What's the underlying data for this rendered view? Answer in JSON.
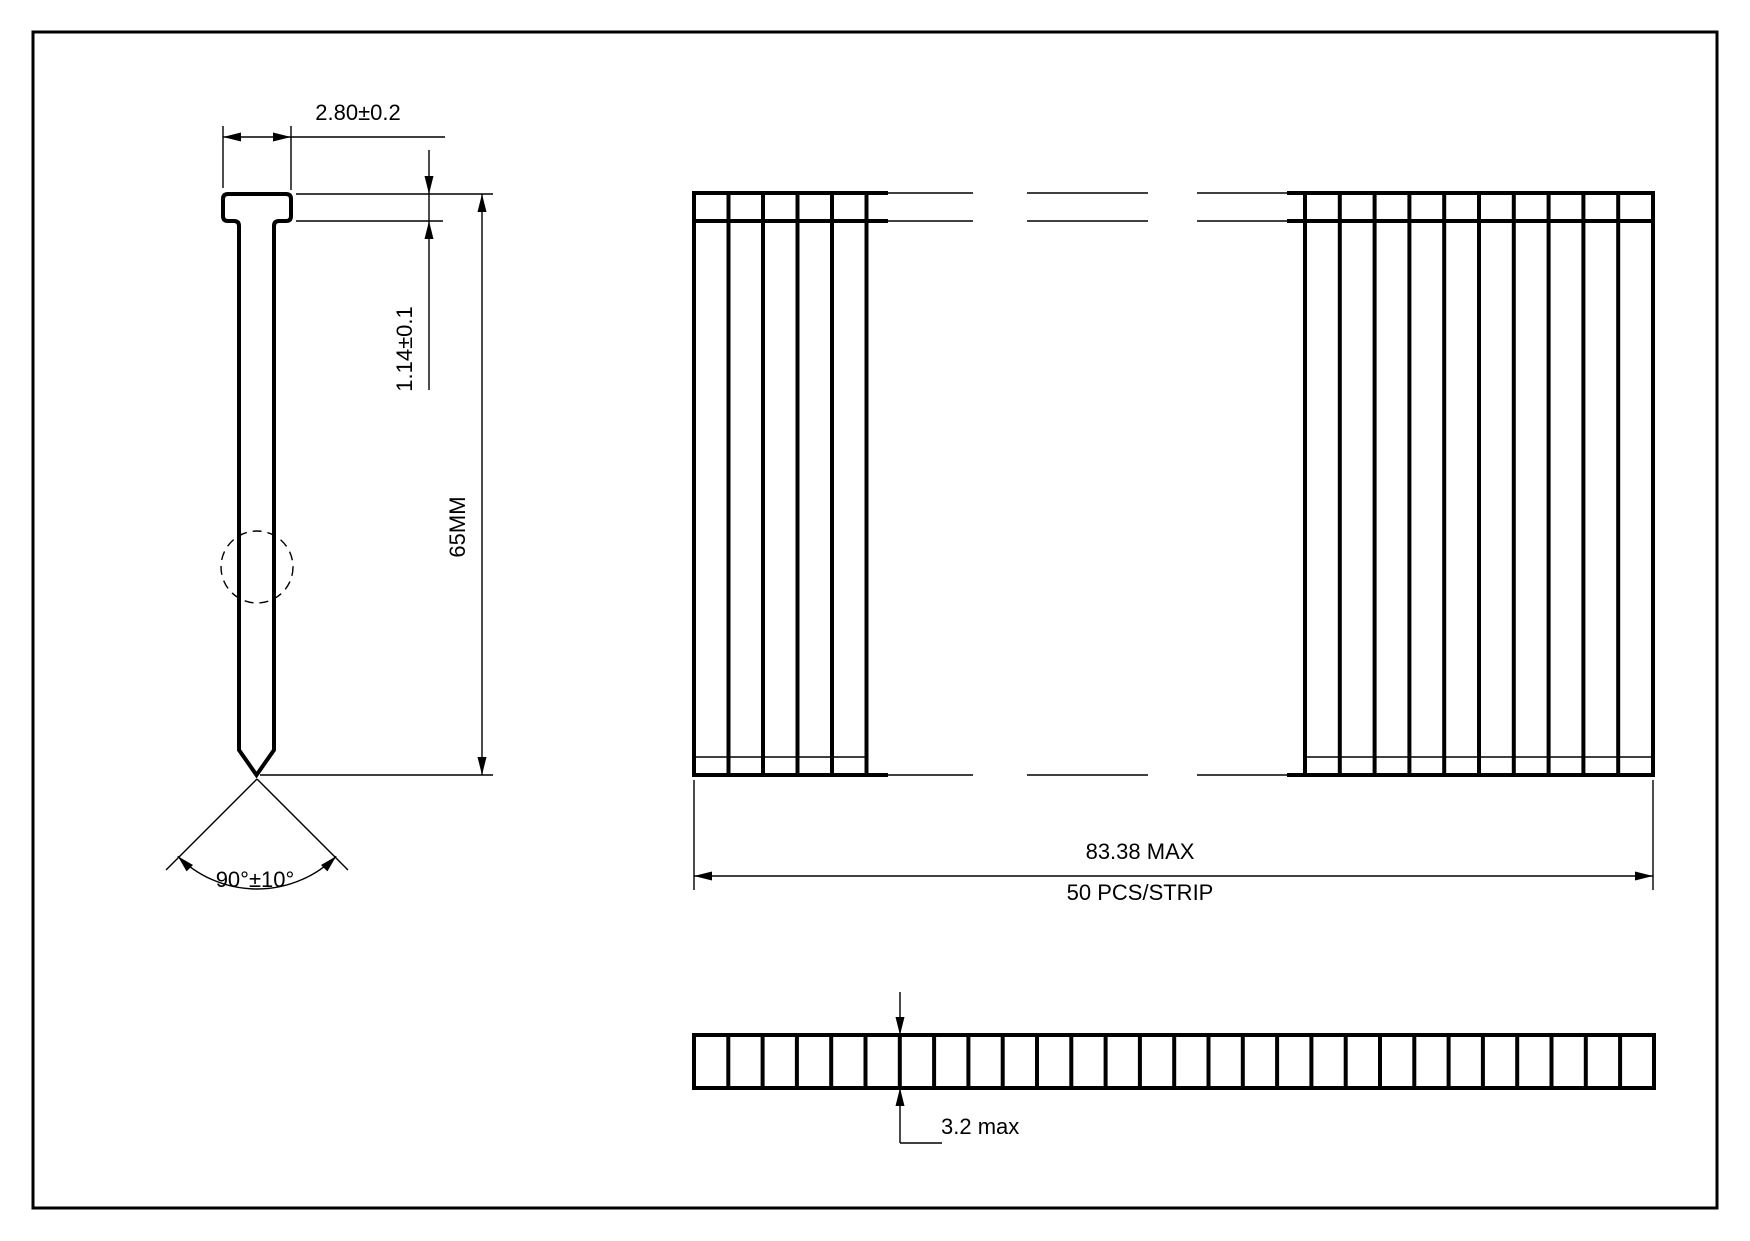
{
  "views": {
    "nail_profile": {
      "head_width": "2.80±0.2",
      "head_thickness": "1.14±0.1",
      "length": "65MM",
      "point_angle": "90°±10°"
    },
    "strip_front": {
      "max_width": "83.38 MAX",
      "pieces_per_strip": "50 PCS/STRIP",
      "left_group_nails_visible": 5,
      "right_group_nails_visible": 10
    },
    "strip_side": {
      "thickness": "3.2 max",
      "segments_visible": 28
    }
  },
  "colors": {
    "line": "#000000",
    "background": "#ffffff"
  }
}
